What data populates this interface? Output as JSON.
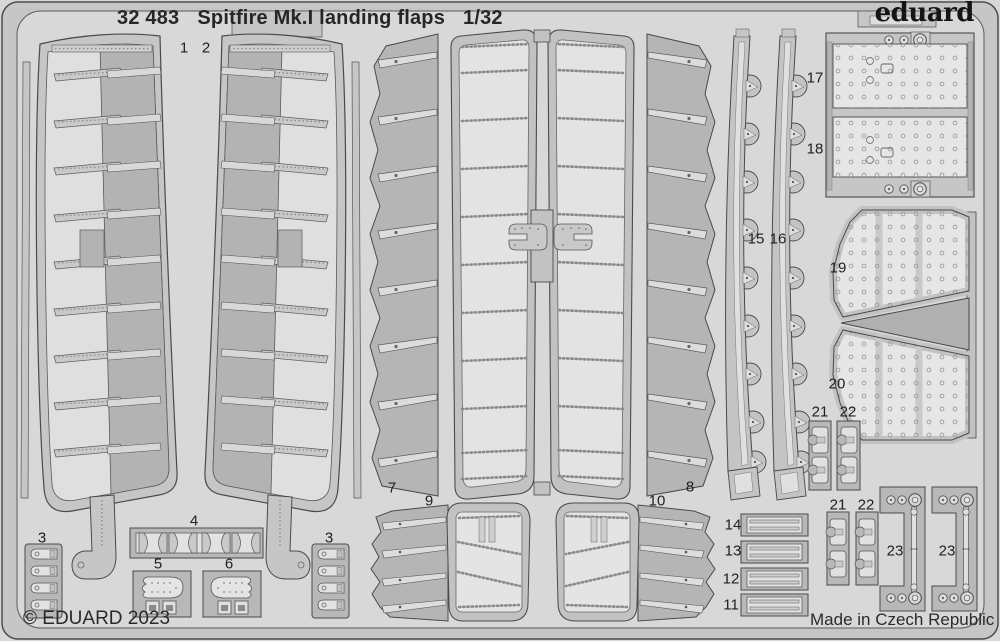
{
  "header": {
    "catalog_number": "32 483",
    "title": "Spitfire Mk.I landing flaps",
    "scale": "1/32"
  },
  "brand": {
    "logo_text": "eduard"
  },
  "footer": {
    "copyright": "© EDUARD 2023",
    "made_in": "Made in Czech Republic"
  },
  "part_labels": [
    "1",
    "2",
    "3",
    "4",
    "5",
    "6",
    "3",
    "7",
    "9",
    "10",
    "8",
    "11",
    "12",
    "13",
    "14",
    "15",
    "16",
    "17",
    "18",
    "19",
    "20",
    "21",
    "22",
    "21",
    "22",
    "23",
    "23"
  ],
  "colors": {
    "sheet_background": "#d7d7d7",
    "fret_frame": "#c6c6c6",
    "part_gray": "#b5b5b5",
    "part_light": "#e4e4e4",
    "outline": "#4a4a4a",
    "text": "#262626"
  }
}
